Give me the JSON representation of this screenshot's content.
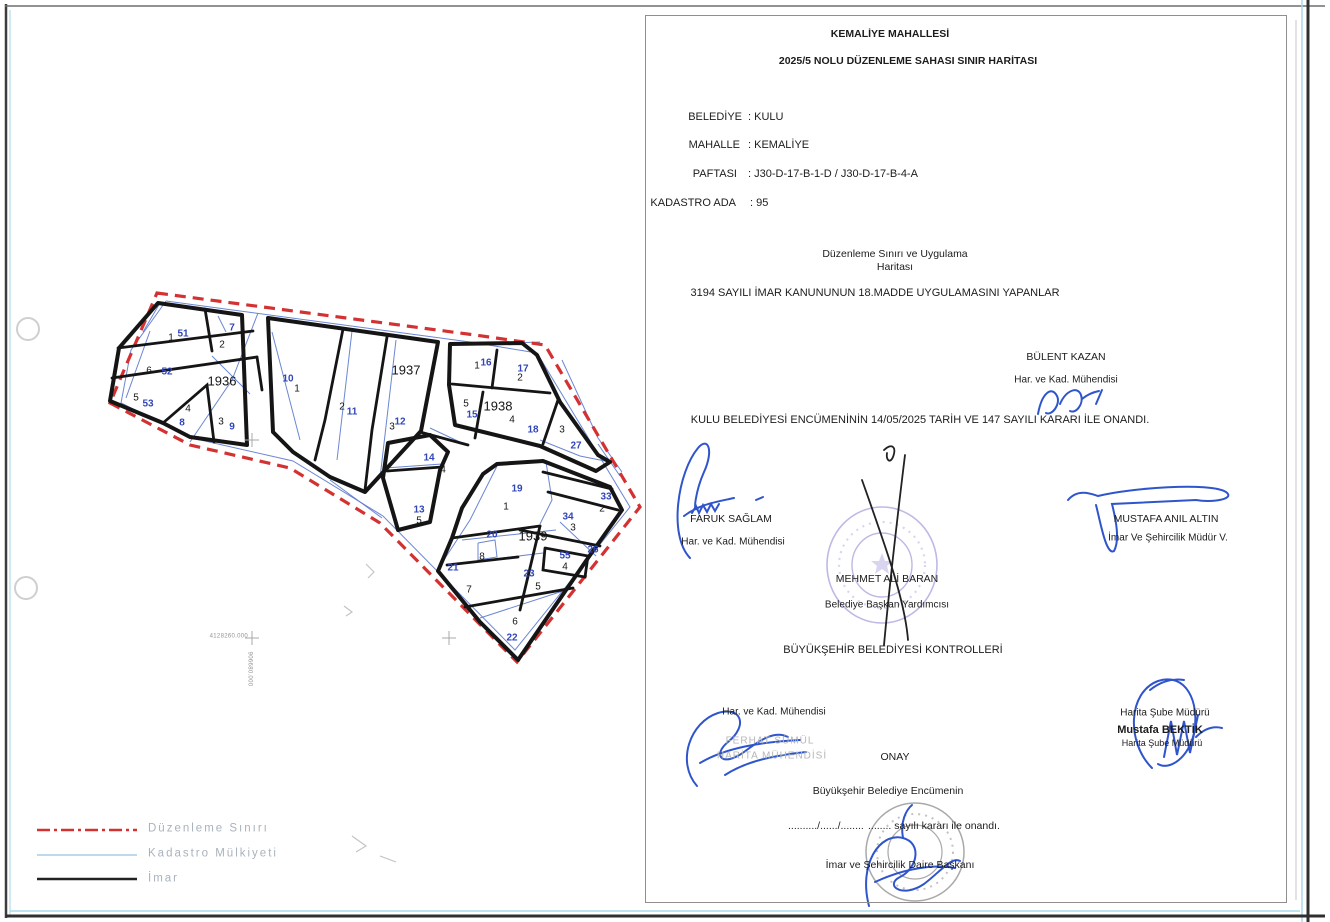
{
  "document": {
    "title_line1": "KEMALİYE  MAHALLESİ",
    "title_line2": "2025/5 NOLU  DÜZENLEME SAHASI SINIR HARİTASI",
    "fields": {
      "belediye_label": "BELEDİYE",
      "belediye_value": ": KULU",
      "mahalle_label": "MAHALLE",
      "mahalle_value": ": KEMALİYE",
      "paftasi_label": "PAFTASI",
      "paftasi_value": ": J30-D-17-B-1-D / J30-D-17-B-4-A",
      "kadastro_ada_label": "KADASTRO ADA",
      "kadastro_ada_value": ": 95"
    },
    "subtitle_line1": "Düzenleme Sınırı ve Uygulama",
    "subtitle_line2": "Haritası",
    "statement": "3194 SAYILI İMAR  KANUNUNUN 18.MADDE UYGULAMASINI YAPANLAR",
    "approval_line": "KULU BELEDİYESİ ENCÜMENİNİN 14/05/2025 TARİH VE 147 SAYILI KARARI İLE ONANDI.",
    "controllers_heading": "BÜYÜKŞEHİR BELEDİYESİ KONTROLLERİ",
    "onay_heading": "ONAY",
    "onay_line1": "Büyükşehir Belediye Encümenin",
    "onay_dots": "........../....../........",
    "onay_line2": "........ sayılı kararı ile onandı.",
    "onay_signer": "İmar  ve Şehircilik Daire Başkanı"
  },
  "people": {
    "bulent_kazan": {
      "name": "BÜLENT KAZAN",
      "title": "Har. ve Kad. Mühendisi"
    },
    "faruk_saglam": {
      "name": "FARUK SAĞLAM",
      "title": "Har. ve Kad. Mühendisi"
    },
    "mustafa_anil_altin": {
      "name": "MUSTAFA ANIL ALTIN",
      "title": "İmar Ve Şehircilik Müdür V."
    },
    "mehmet_ali_baran": {
      "name": "MEHMET ALİ BARAN",
      "title": "Belediye Başkan Yardımcısı"
    },
    "ferhat": {
      "title": "Har. ve Kad. Mühendisi",
      "stamp_name": "FERHAT SÜMÜL",
      "stamp_title": "HARİTA MÜHENDİSİ"
    },
    "mustafa_bektik": {
      "title_above": "Harita Şube Müdürü",
      "name": "Mustafa BEKTİK",
      "title_below": "Harita Şube Müdürü"
    }
  },
  "legend": {
    "items": [
      {
        "label": "Düzenleme Sınırı",
        "color": "#d43232",
        "style": "dashdot"
      },
      {
        "label": "Kadastro Mülkiyeti",
        "color": "#a9cbe8",
        "style": "solid"
      },
      {
        "label": "İmar",
        "color": "#222222",
        "style": "solid"
      }
    ]
  },
  "map": {
    "coord_label_x": "4128260.000",
    "coord_label_y": "906680.000",
    "colors": {
      "imar": "#151515",
      "kadastro": "#5b79cf",
      "duzenleme": "#d43232",
      "parcel_black": "#161616",
      "parcel_blue": "#3146b8"
    },
    "red_boundary": [
      [
        157,
        293
      ],
      [
        475,
        335
      ],
      [
        545,
        345
      ],
      [
        640,
        507
      ],
      [
        517,
        662
      ],
      [
        380,
        523
      ],
      [
        290,
        468
      ],
      [
        190,
        445
      ],
      [
        110,
        403
      ]
    ],
    "blocks": [
      {
        "name": "1936",
        "pts": [
          [
            158,
            303
          ],
          [
            242,
            315
          ],
          [
            247,
            445
          ],
          [
            190,
            437
          ],
          [
            163,
            423
          ],
          [
            110,
            401
          ],
          [
            119,
            348
          ]
        ]
      },
      {
        "name": "1937",
        "pts": [
          [
            268,
            318
          ],
          [
            438,
            342
          ],
          [
            421,
            431
          ],
          [
            365,
            492
          ],
          [
            330,
            477
          ],
          [
            293,
            452
          ],
          [
            273,
            432
          ]
        ]
      },
      {
        "name": "1938",
        "pts": [
          [
            450,
            344
          ],
          [
            522,
            343
          ],
          [
            537,
            355
          ],
          [
            560,
            402
          ],
          [
            598,
            455
          ],
          [
            610,
            462
          ],
          [
            596,
            471
          ],
          [
            540,
            446
          ],
          [
            455,
            425
          ],
          [
            449,
            385
          ]
        ]
      },
      {
        "name": "1939",
        "pts": [
          [
            497,
            464
          ],
          [
            543,
            461
          ],
          [
            610,
            487
          ],
          [
            622,
            510
          ],
          [
            588,
            558
          ],
          [
            518,
            660
          ],
          [
            480,
            622
          ],
          [
            438,
            571
          ],
          [
            452,
            538
          ],
          [
            462,
            508
          ],
          [
            483,
            474
          ]
        ]
      },
      {
        "name": "ada-13",
        "pts": [
          [
            388,
            443
          ],
          [
            430,
            435
          ],
          [
            448,
            452
          ],
          [
            440,
            470
          ],
          [
            430,
            522
          ],
          [
            398,
            530
          ],
          [
            383,
            478
          ]
        ]
      }
    ],
    "inner": [
      [
        [
          118,
          348
        ],
        [
          253,
          331
        ]
      ],
      [
        [
          112,
          378
        ],
        [
          257,
          357
        ]
      ],
      [
        [
          205,
          309
        ],
        [
          212,
          351
        ]
      ],
      [
        [
          163,
          423
        ],
        [
          207,
          385
        ],
        [
          214,
          442
        ]
      ],
      [
        [
          257,
          357
        ],
        [
          262,
          390
        ]
      ],
      [
        [
          343,
          329
        ],
        [
          325,
          420
        ],
        [
          315,
          460
        ]
      ],
      [
        [
          387,
          337
        ],
        [
          372,
          430
        ],
        [
          365,
          490
        ]
      ],
      [
        [
          452,
          384
        ],
        [
          550,
          393
        ]
      ],
      [
        [
          497,
          350
        ],
        [
          492,
          388
        ]
      ],
      [
        [
          483,
          392
        ],
        [
          475,
          438
        ]
      ],
      [
        [
          558,
          400
        ],
        [
          543,
          444
        ]
      ],
      [
        [
          452,
          538
        ],
        [
          540,
          526
        ]
      ],
      [
        [
          447,
          565
        ],
        [
          518,
          557
        ]
      ],
      [
        [
          540,
          526
        ],
        [
          520,
          610
        ]
      ],
      [
        [
          543,
          472
        ],
        [
          612,
          489
        ]
      ],
      [
        [
          548,
          492
        ],
        [
          618,
          510
        ]
      ],
      [
        [
          520,
          530
        ],
        [
          600,
          546
        ]
      ],
      [
        [
          545,
          548
        ],
        [
          588,
          556
        ],
        [
          585,
          577
        ],
        [
          543,
          570
        ],
        [
          545,
          548
        ]
      ],
      [
        [
          465,
          607
        ],
        [
          573,
          588
        ]
      ],
      [
        [
          387,
          471
        ],
        [
          442,
          467
        ]
      ],
      [
        [
          420,
          432
        ],
        [
          468,
          445
        ]
      ]
    ],
    "blue": [
      [
        [
          166,
          301
        ],
        [
          470,
          342
        ],
        [
          537,
          353
        ],
        [
          630,
          507
        ],
        [
          515,
          650
        ],
        [
          383,
          516
        ],
        [
          293,
          461
        ],
        [
          196,
          439
        ],
        [
          121,
          403
        ],
        [
          131,
          350
        ],
        [
          166,
          301
        ]
      ],
      [
        [
          258,
          313
        ],
        [
          232,
          380
        ],
        [
          190,
          442
        ]
      ],
      [
        [
          150,
          331
        ],
        [
          126,
          398
        ]
      ],
      [
        [
          212,
          356
        ],
        [
          250,
          394
        ]
      ],
      [
        [
          352,
          331
        ],
        [
          337,
          460
        ]
      ],
      [
        [
          396,
          340
        ],
        [
          380,
          478
        ]
      ],
      [
        [
          272,
          332
        ],
        [
          300,
          440
        ]
      ],
      [
        [
          455,
          345
        ],
        [
          540,
          342
        ]
      ],
      [
        [
          562,
          360
        ],
        [
          598,
          438
        ],
        [
          622,
          472
        ]
      ],
      [
        [
          540,
          440
        ],
        [
          580,
          456
        ],
        [
          610,
          462
        ]
      ],
      [
        [
          430,
          428
        ],
        [
          462,
          443
        ]
      ],
      [
        [
          385,
          468
        ],
        [
          442,
          464
        ]
      ],
      [
        [
          497,
          466
        ],
        [
          470,
          520
        ],
        [
          438,
          569
        ]
      ],
      [
        [
          546,
          462
        ],
        [
          552,
          500
        ],
        [
          540,
          524
        ]
      ],
      [
        [
          462,
          540
        ],
        [
          556,
          530
        ]
      ],
      [
        [
          470,
          562
        ],
        [
          543,
          553
        ]
      ],
      [
        [
          480,
          618
        ],
        [
          566,
          590
        ]
      ],
      [
        [
          560,
          522
        ],
        [
          596,
          556
        ]
      ],
      [
        [
          598,
          444
        ],
        [
          620,
          476
        ]
      ],
      [
        [
          478,
          543
        ],
        [
          495,
          540
        ],
        [
          497,
          557
        ],
        [
          478,
          560
        ],
        [
          478,
          543
        ]
      ],
      [
        [
          330,
          480
        ],
        [
          382,
          518
        ]
      ],
      [
        [
          218,
          316
        ],
        [
          226,
          332
        ]
      ],
      [
        [
          160,
          303
        ],
        [
          143,
          332
        ]
      ]
    ],
    "crosses": [
      [
        252,
        638
      ],
      [
        449,
        638
      ],
      [
        252,
        440
      ]
    ],
    "pencil": [
      [
        [
          366,
          564
        ],
        [
          374,
          572
        ],
        [
          368,
          578
        ]
      ],
      [
        [
          344,
          606
        ],
        [
          352,
          612
        ],
        [
          346,
          616
        ]
      ],
      [
        [
          352,
          836
        ],
        [
          366,
          846
        ],
        [
          356,
          852
        ]
      ],
      [
        [
          380,
          856
        ],
        [
          396,
          862
        ]
      ]
    ],
    "labels": [
      {
        "t": "1936",
        "x": 222,
        "y": 381,
        "c": "k",
        "s": 13
      },
      {
        "t": "1937",
        "x": 406,
        "y": 370,
        "c": "k",
        "s": 13
      },
      {
        "t": "1938",
        "x": 498,
        "y": 406,
        "c": "k",
        "s": 13
      },
      {
        "t": "1939",
        "x": 533,
        "y": 536,
        "c": "k",
        "s": 13
      },
      {
        "t": "1",
        "x": 171,
        "y": 338,
        "c": "k",
        "s": 10
      },
      {
        "t": "51",
        "x": 183,
        "y": 334,
        "c": "b",
        "s": 10
      },
      {
        "t": "7",
        "x": 232,
        "y": 328,
        "c": "b",
        "s": 10
      },
      {
        "t": "2",
        "x": 222,
        "y": 345,
        "c": "k",
        "s": 10
      },
      {
        "t": "6",
        "x": 149,
        "y": 371,
        "c": "k",
        "s": 10
      },
      {
        "t": "52",
        "x": 167,
        "y": 372,
        "c": "b",
        "s": 10
      },
      {
        "t": "5",
        "x": 136,
        "y": 398,
        "c": "k",
        "s": 10
      },
      {
        "t": "53",
        "x": 148,
        "y": 404,
        "c": "b",
        "s": 10
      },
      {
        "t": "4",
        "x": 188,
        "y": 409,
        "c": "k",
        "s": 10
      },
      {
        "t": "8",
        "x": 182,
        "y": 423,
        "c": "b",
        "s": 10
      },
      {
        "t": "3",
        "x": 221,
        "y": 422,
        "c": "k",
        "s": 10
      },
      {
        "t": "9",
        "x": 232,
        "y": 427,
        "c": "b",
        "s": 10
      },
      {
        "t": "10",
        "x": 288,
        "y": 379,
        "c": "b",
        "s": 10
      },
      {
        "t": "1",
        "x": 297,
        "y": 389,
        "c": "k",
        "s": 10
      },
      {
        "t": "2",
        "x": 342,
        "y": 407,
        "c": "k",
        "s": 10
      },
      {
        "t": "11",
        "x": 352,
        "y": 412,
        "c": "b",
        "s": 10
      },
      {
        "t": "3",
        "x": 392,
        "y": 427,
        "c": "k",
        "s": 10
      },
      {
        "t": "12",
        "x": 400,
        "y": 422,
        "c": "b",
        "s": 10
      },
      {
        "t": "1",
        "x": 477,
        "y": 366,
        "c": "k",
        "s": 10
      },
      {
        "t": "16",
        "x": 486,
        "y": 363,
        "c": "b",
        "s": 10
      },
      {
        "t": "17",
        "x": 523,
        "y": 369,
        "c": "b",
        "s": 10
      },
      {
        "t": "2",
        "x": 520,
        "y": 378,
        "c": "k",
        "s": 10
      },
      {
        "t": "5",
        "x": 466,
        "y": 404,
        "c": "k",
        "s": 10
      },
      {
        "t": "15",
        "x": 472,
        "y": 415,
        "c": "b",
        "s": 10
      },
      {
        "t": "4",
        "x": 512,
        "y": 420,
        "c": "k",
        "s": 10
      },
      {
        "t": "18",
        "x": 533,
        "y": 430,
        "c": "b",
        "s": 10
      },
      {
        "t": "3",
        "x": 562,
        "y": 430,
        "c": "k",
        "s": 10
      },
      {
        "t": "27",
        "x": 576,
        "y": 446,
        "c": "b",
        "s": 10
      },
      {
        "t": "14",
        "x": 429,
        "y": 458,
        "c": "b",
        "s": 10
      },
      {
        "t": "4",
        "x": 443,
        "y": 470,
        "c": "k",
        "s": 10
      },
      {
        "t": "13",
        "x": 419,
        "y": 510,
        "c": "b",
        "s": 10
      },
      {
        "t": "5",
        "x": 419,
        "y": 521,
        "c": "k",
        "s": 10
      },
      {
        "t": "19",
        "x": 517,
        "y": 489,
        "c": "b",
        "s": 10
      },
      {
        "t": "1",
        "x": 506,
        "y": 507,
        "c": "k",
        "s": 10
      },
      {
        "t": "20",
        "x": 492,
        "y": 535,
        "c": "b",
        "s": 10
      },
      {
        "t": "8",
        "x": 482,
        "y": 557,
        "c": "k",
        "s": 10
      },
      {
        "t": "21",
        "x": 453,
        "y": 568,
        "c": "b",
        "s": 10
      },
      {
        "t": "7",
        "x": 469,
        "y": 590,
        "c": "k",
        "s": 10
      },
      {
        "t": "23",
        "x": 529,
        "y": 574,
        "c": "b",
        "s": 10
      },
      {
        "t": "5",
        "x": 538,
        "y": 587,
        "c": "k",
        "s": 10
      },
      {
        "t": "6",
        "x": 515,
        "y": 622,
        "c": "k",
        "s": 10
      },
      {
        "t": "22",
        "x": 512,
        "y": 638,
        "c": "b",
        "s": 10
      },
      {
        "t": "33",
        "x": 606,
        "y": 497,
        "c": "b",
        "s": 10
      },
      {
        "t": "2",
        "x": 602,
        "y": 509,
        "c": "k",
        "s": 10
      },
      {
        "t": "34",
        "x": 568,
        "y": 517,
        "c": "b",
        "s": 10
      },
      {
        "t": "3",
        "x": 573,
        "y": 528,
        "c": "k",
        "s": 10
      },
      {
        "t": "55",
        "x": 565,
        "y": 556,
        "c": "b",
        "s": 10
      },
      {
        "t": "4",
        "x": 565,
        "y": 567,
        "c": "k",
        "s": 10
      },
      {
        "t": "26",
        "x": 593,
        "y": 550,
        "c": "b",
        "s": 10
      }
    ]
  }
}
